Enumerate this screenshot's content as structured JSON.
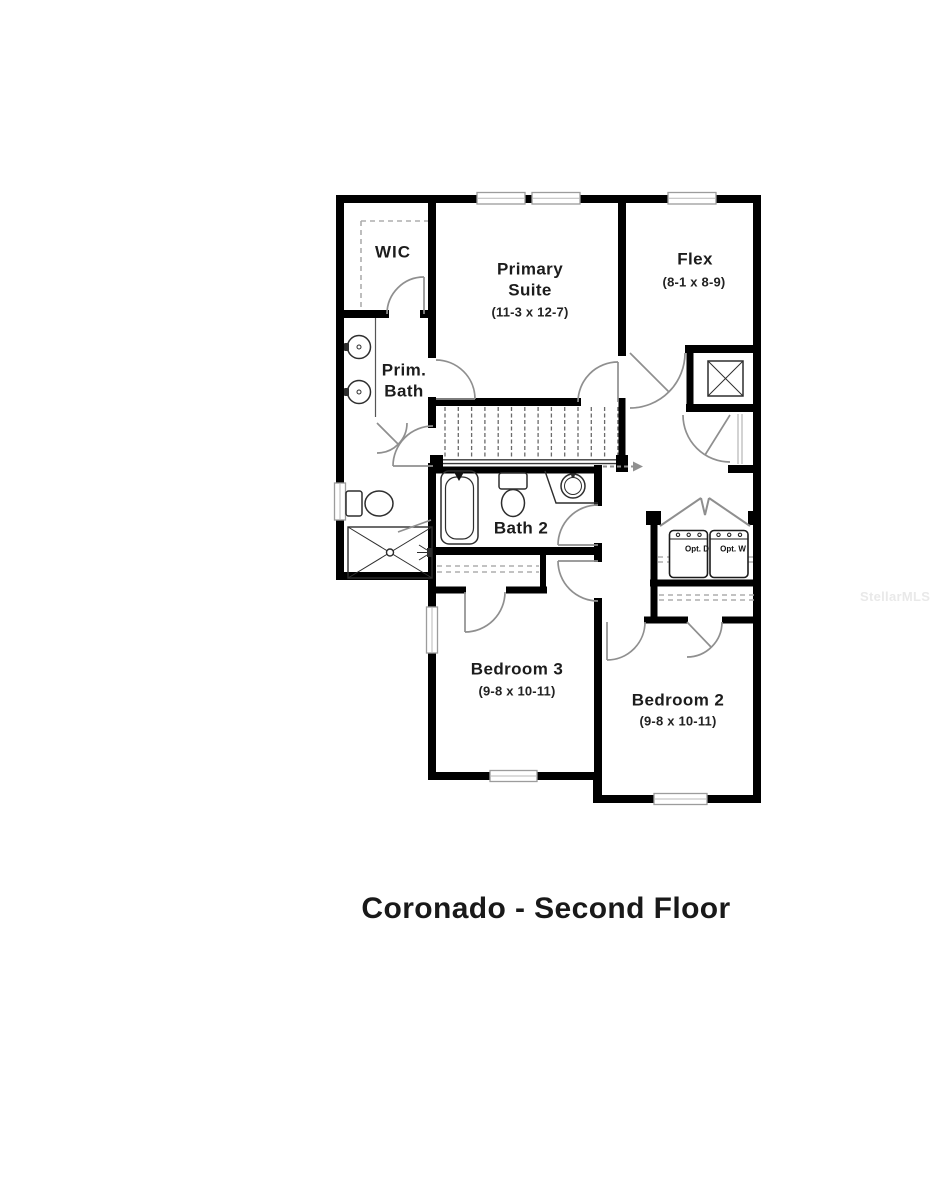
{
  "title": "Coronado - Second Floor",
  "watermark": "StellarMLS",
  "rooms": {
    "wic": {
      "name": "WIC"
    },
    "primary_suite": {
      "name": "Primary Suite",
      "dims": "(11-3 x 12-7)"
    },
    "flex": {
      "name": "Flex",
      "dims": "(8-1 x 8-9)"
    },
    "prim_bath": {
      "name": "Prim. Bath"
    },
    "bath2": {
      "name": "Bath 2"
    },
    "bedroom3": {
      "name": "Bedroom 3",
      "dims": "(9-8 x 10-11)"
    },
    "bedroom2": {
      "name": "Bedroom 2",
      "dims": "(9-8 x 10-11)"
    }
  },
  "appliances": {
    "dryer_label": "Opt. D",
    "washer_label": "Opt. W"
  },
  "colors": {
    "wall": "#000000",
    "door": "#8f8f8f",
    "fixture": "#2e2e2e",
    "dash": "#adadad",
    "window_frame": "#9c9c9c"
  }
}
